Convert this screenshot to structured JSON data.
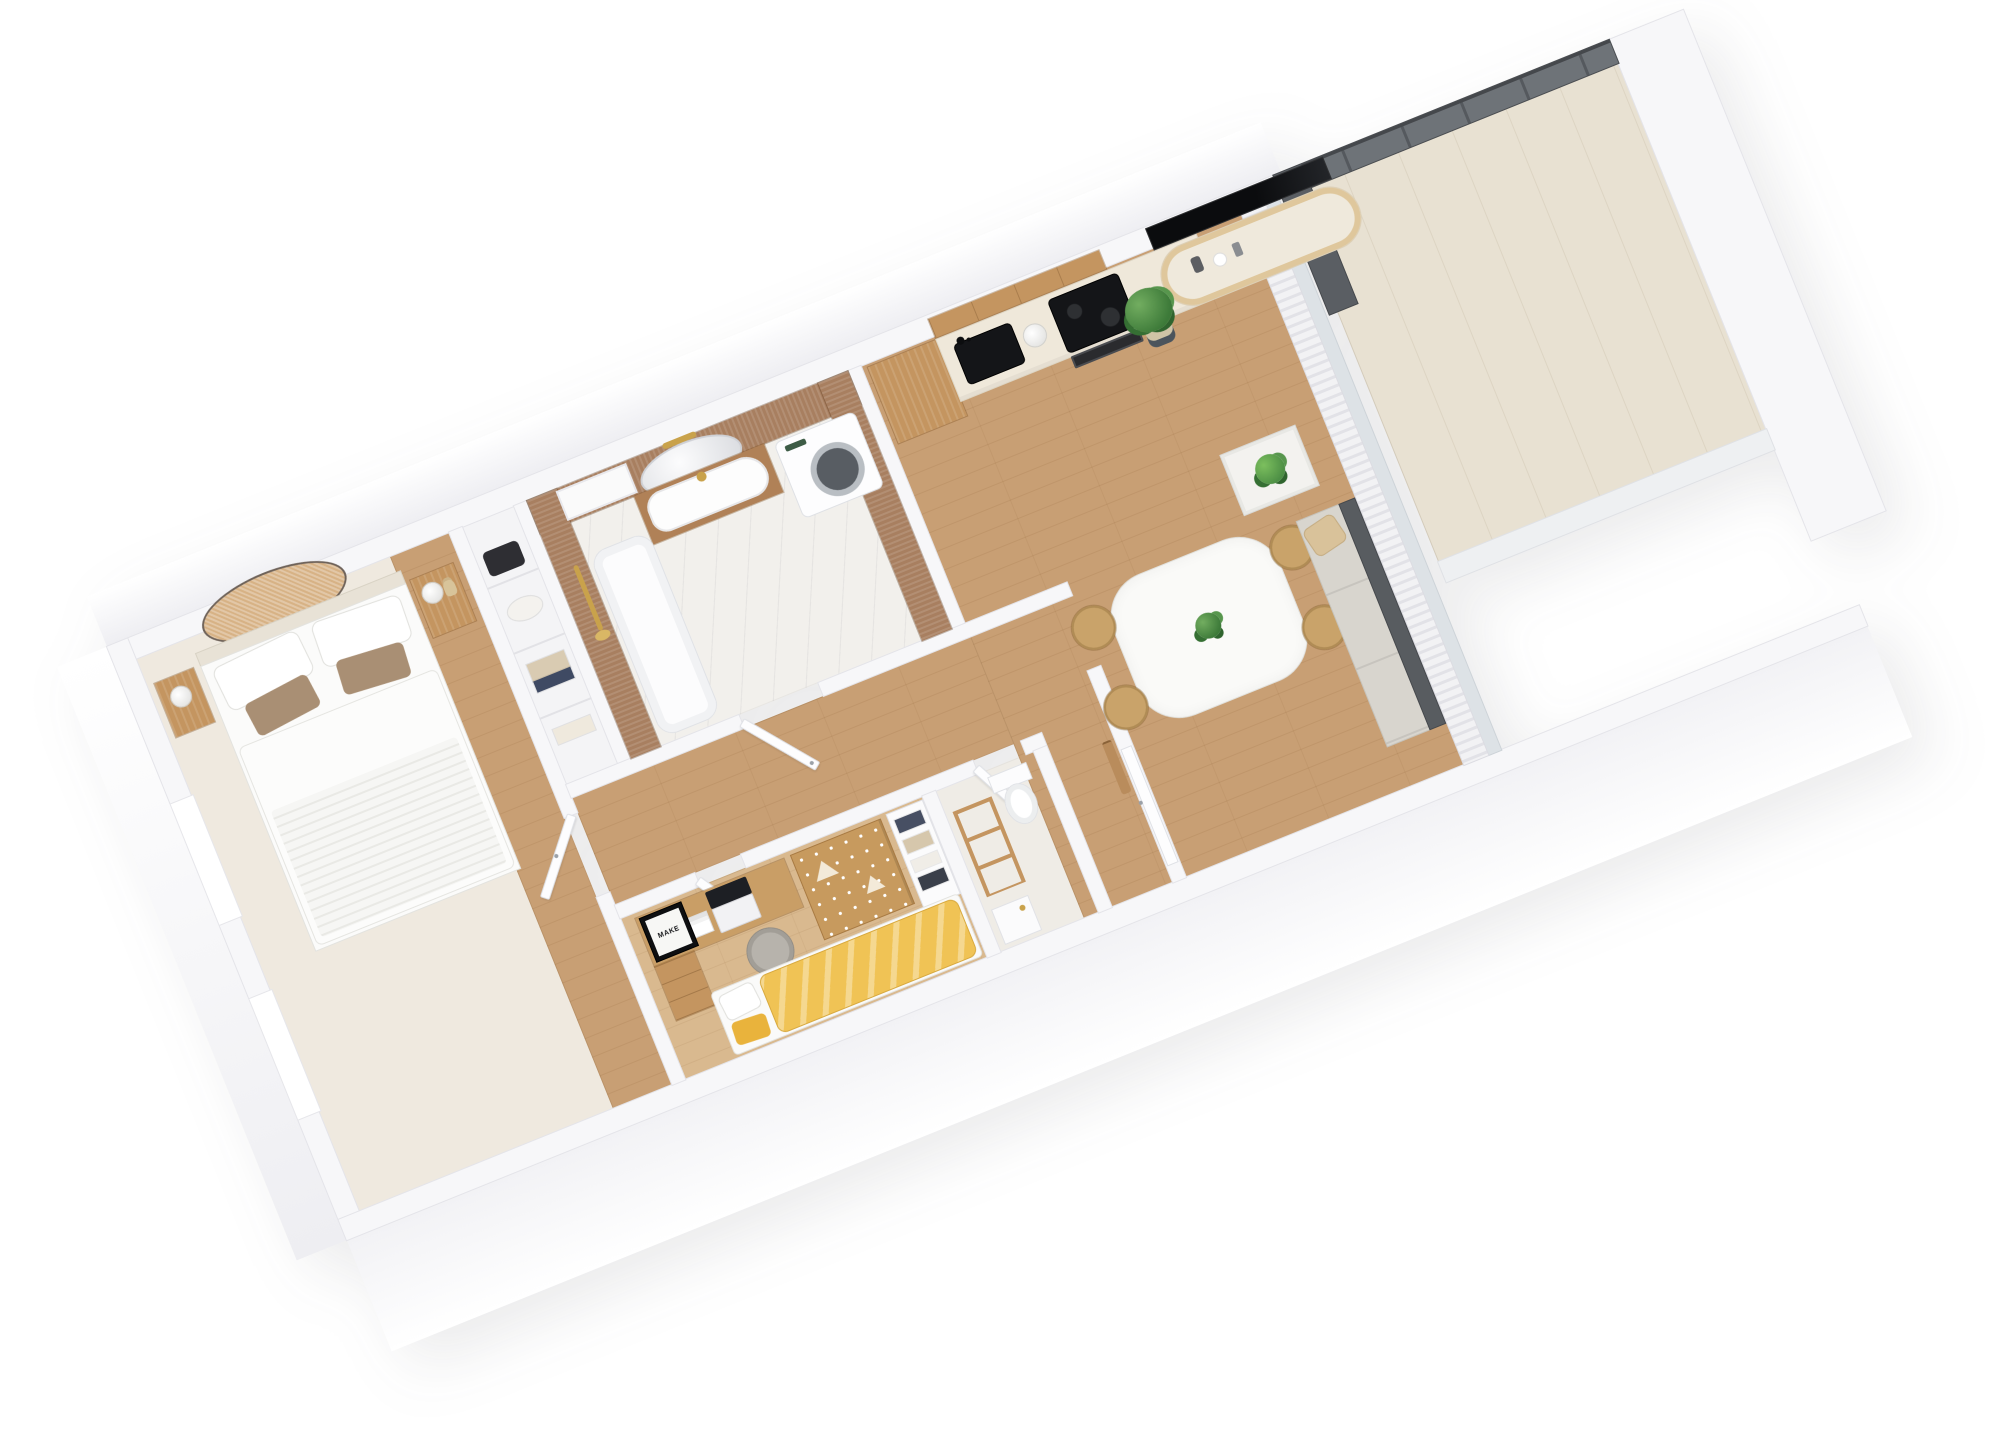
{
  "scene": {
    "type": "3d-floor-plan-render",
    "style": "isometric cutaway apartment, white walls, oak floors",
    "background": "#ffffff",
    "rotation_deg": -22
  },
  "palette": {
    "wall": "#f7f7f9",
    "wall_edge": "#e4e4e9",
    "oak_floor": "#c89f74",
    "light_oak_floor": "#d9b98f",
    "cream_counter": "#efe8da",
    "cabinet_oak": "#c49560",
    "walnut_panel": "#a87f60",
    "rattan_decor": "#d7b285",
    "black_appliance": "#141518",
    "plant_green": "#4e8f4a",
    "sofa_gray": "#585c60",
    "yellow_blanket": "#f0c355",
    "taupe_pillow": "#a98f74",
    "brass": "#c9a24b",
    "smoked_glass": "#6e7378",
    "marble_floor": "#f2f0ec",
    "chair_tan": "#c9a36a"
  },
  "poster": {
    "text": "MAKE"
  },
  "rooms": [
    {
      "id": "bedroom",
      "name": "Main bedroom",
      "items": [
        "double bed with quilted duvet",
        "white and taupe pillows",
        "two wooden nightstands",
        "white table lamps",
        "dried pampas vase",
        "oval rattan wall panel",
        "two window recesses",
        "built-in closet with bag, hat and folded clothes"
      ]
    },
    {
      "id": "bathroom",
      "name": "Bathroom",
      "items": [
        "walnut slat wall panels",
        "oval mirror with brass sconce",
        "wooden vanity with white basin",
        "brass shower on rail",
        "bathtub",
        "washing machine",
        "marble floor",
        "window niche"
      ]
    },
    {
      "id": "kitchen",
      "name": "Kitchen run",
      "items": [
        "tall oak cabinet",
        "oak upper cabinets",
        "cream countertop",
        "black sink with black tap",
        "white kettle",
        "black induction hob",
        "built-in oven"
      ]
    },
    {
      "id": "living",
      "name": "Living / dining room",
      "items": [
        "wall-mounted TV",
        "curved oak sideboard with vases",
        "potted plant",
        "white dining table with plant centerpiece",
        "four tan dining chairs",
        "coffee table with palm plant",
        "gray sofa with beige pillow",
        "sheer curtains",
        "sliding glass wall"
      ]
    },
    {
      "id": "hallway",
      "name": "Hallway",
      "items": [
        "oak floor",
        "open white interior doors",
        "entry door",
        "wooden coat hooks"
      ]
    },
    {
      "id": "wc",
      "name": "WC",
      "items": [
        "toilet",
        "wooden ladder towel rack",
        "white cabinet with brass tap"
      ]
    },
    {
      "id": "kids-room",
      "name": "Second bedroom / office",
      "items": [
        "oak desk",
        "laptop",
        "black framed poster",
        "magazine",
        "oak drawer unit",
        "gray upholstered chair",
        "patterned oak wardrobe",
        "white shelf with folded clothes",
        "white stool",
        "bed with yellow blanket"
      ]
    },
    {
      "id": "balcony",
      "name": "Balcony",
      "items": [
        "smoked glass balustrade",
        "glass privacy partition",
        "light decking",
        "white exterior wall"
      ]
    }
  ]
}
